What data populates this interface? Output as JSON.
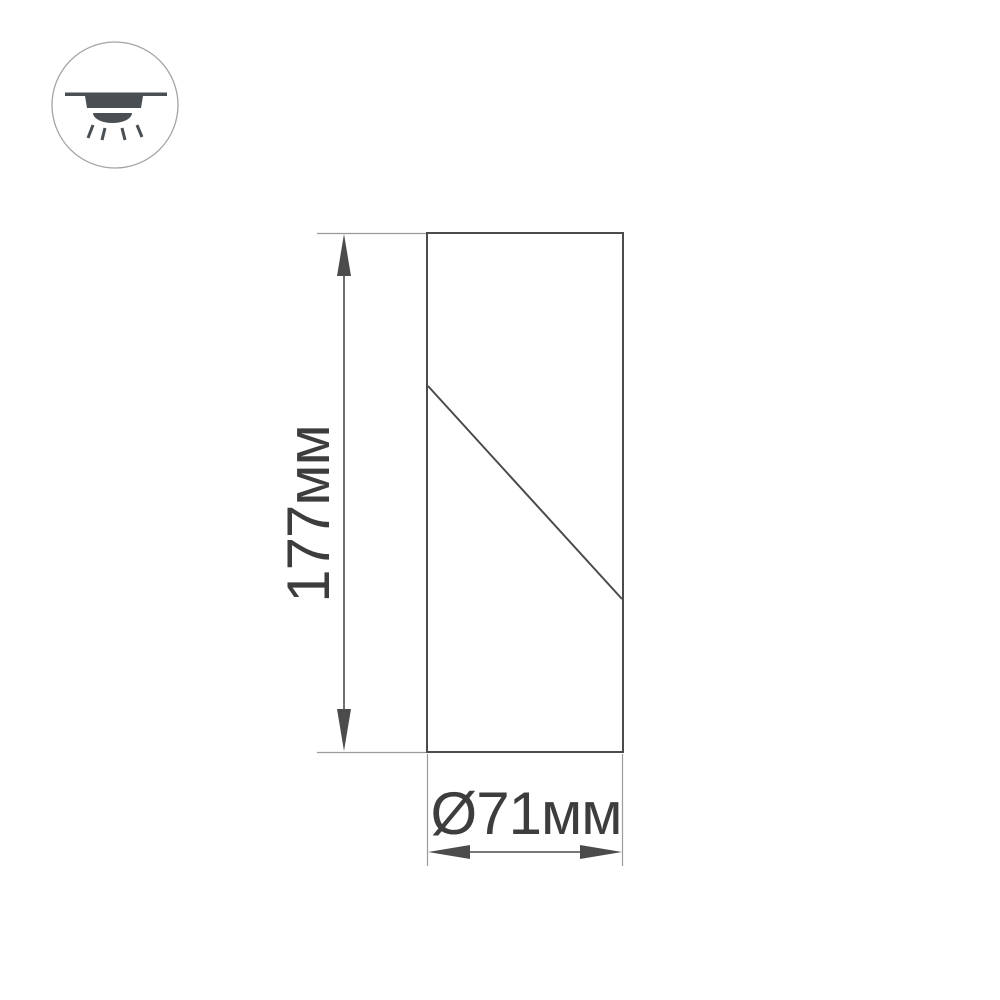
{
  "page": {
    "type": "product-technical-drawing",
    "background_color": "#ffffff"
  },
  "icon": {
    "name": "surface-mount-downlight-icon",
    "meaning": "ceiling surface-mounted luminaire with downward light"
  },
  "drawing": {
    "subject": "cylindrical luminaire body outline with diagonal cut line"
  },
  "dimensions": {
    "height": {
      "label": "177мм",
      "value": 177,
      "unit": "мм",
      "orientation": "vertical"
    },
    "diameter": {
      "label": "Ø71мм",
      "value": 71,
      "unit": "мм",
      "orientation": "horizontal"
    }
  },
  "colors": {
    "outline_line": "#4b4b4b",
    "extension_line": "#9a9a9a",
    "dimension_line": "#4b4b4b",
    "text": "#3d3d3d",
    "icon_fill": "#4a4f54",
    "icon_circle_stroke": "#a3a3a3",
    "background": "#ffffff"
  }
}
